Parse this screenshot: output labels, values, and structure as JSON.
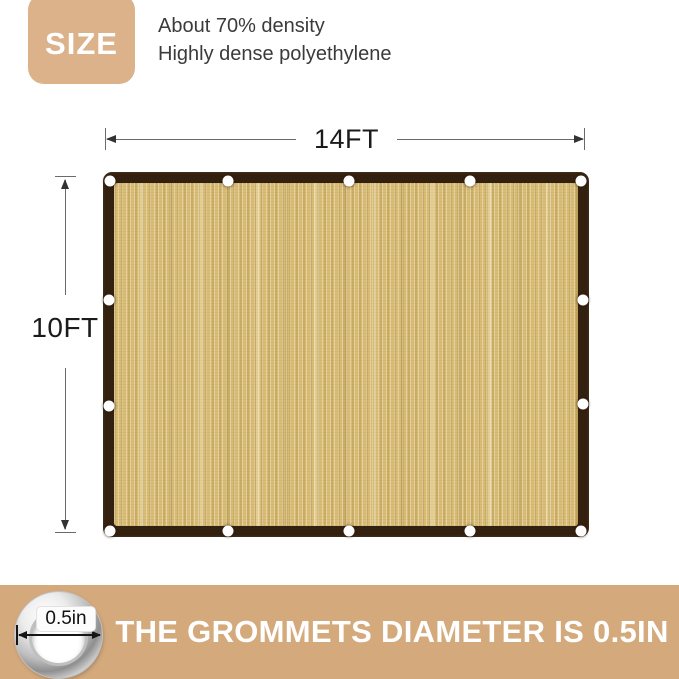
{
  "badge": {
    "label": "SIZE"
  },
  "description": {
    "line1": "About 70% density",
    "line2": "Highly dense polyethylene"
  },
  "dimensions": {
    "width_label": "14FT",
    "height_label": "10FT"
  },
  "banner": {
    "text": "THE GROMMETS DIAMETER IS 0.5IN",
    "grommet_diameter_label": "0.5in"
  },
  "grommets": {
    "top_count": 5,
    "bottom_count": 5,
    "left_middle_count": 2,
    "right_middle_count": 2
  },
  "colors": {
    "badge_tan": "#dbb28a",
    "banner_tan": "#d4a97c",
    "cloth_border_brown": "#34200f",
    "fabric_tan": "#d9bd75",
    "grommet_white": "#ffffff",
    "text_dark": "#3b3b3b",
    "dimension_line": "#6a6a6a"
  }
}
